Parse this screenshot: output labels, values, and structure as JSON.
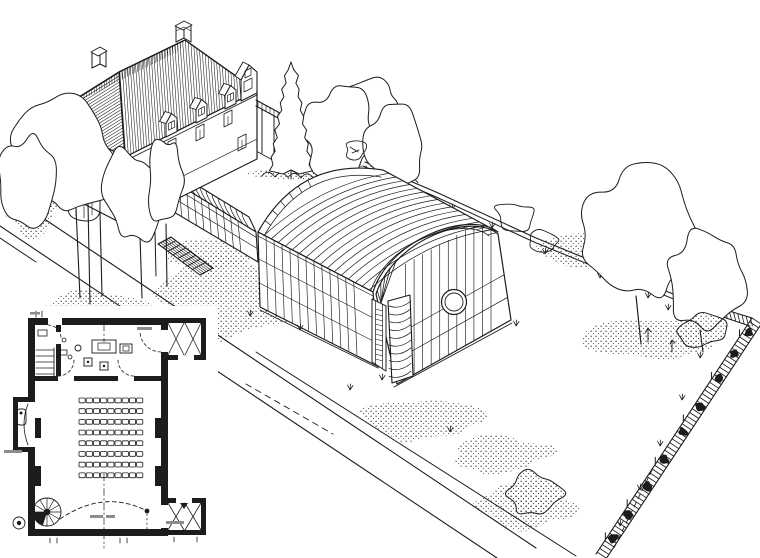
{
  "canvas": {
    "background": "#ffffff",
    "ink": "#1c1c1c",
    "faint_ink": "#8d8d8d"
  },
  "drawing": {
    "kind": "black-and-white architectural line illustration",
    "view": "aerial axonometric view of a villa with a barrel-vaulted glazed hall in a walled garden",
    "scene": {
      "villa": "two-storey villa with hatched hipped roof, three dormers, gable bay, two chimneys, round corner bay and side pergola",
      "link": "barrel-vaulted glazed corridor linking the villa to the hall",
      "hall": "barrel-vaulted glazed hall with ribbed roof, round porthole window, ladder door and banded corner piers",
      "garden": "walled garden with lawn, gravel walk, garden steps, clipped shrub beds and mature trees",
      "fence": "hatched trellis fence along the right boundary"
    }
  },
  "floor_plan": {
    "kind": "floor plan inset of the vaulted hall",
    "seating": {
      "rows": 8,
      "seats_per_row": 9
    },
    "features": [
      "stage area with furniture",
      "straight stair",
      "spiral stair",
      "side bay room",
      "entry vestibules with diagonal cross bracing",
      "dashed door-swing arc",
      "dash-dot centre line"
    ],
    "captions": [
      {
        "id": "footer-caption",
        "legible": false
      },
      {
        "id": "vestibule-caption",
        "legible": false
      },
      {
        "id": "left-wall-caption",
        "legible": false
      },
      {
        "id": "stage-caption",
        "legible": false
      }
    ]
  }
}
